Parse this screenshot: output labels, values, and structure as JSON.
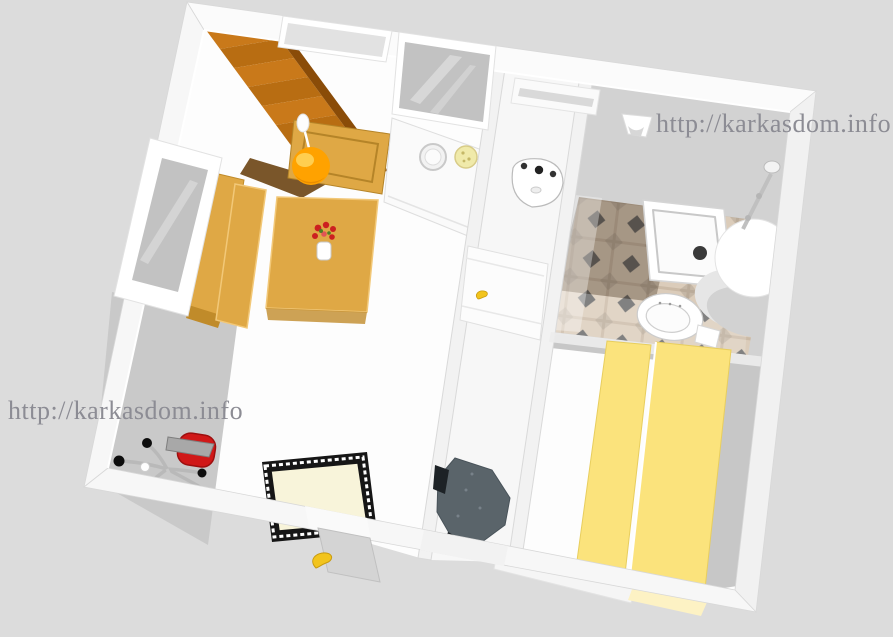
{
  "watermarks": {
    "top_right": "http://karkasdom.info",
    "bottom_left": "http://karkasdom.info"
  },
  "colors": {
    "background": "#dcdcdc",
    "watermark_gray": "#8c8c94",
    "wall_white": "#f7f7f7",
    "wall_top_band": "#fbfbfb",
    "floor_white": "#fdfdfd",
    "floor_shadow": "#c9c9c9",
    "bath_shadow_floor": "#d2d2d2",
    "glass_gray": "#c2c2c2",
    "glass_light": "#e2e2e2",
    "stairs_top": "#c9791a",
    "stairs_step": "#b86d12",
    "stairs_side": "#8a4c08",
    "stairs_shadow": "#6b4413",
    "wood_tan": "#dfa845",
    "wood_tan_side": "#c08b2a",
    "lamp_orange": "#ffa200",
    "lamp_highlight": "#ffd65e",
    "tile_base": "#dbccba",
    "tile_diamond": "#666666",
    "bed_yellow": "#fbe37c",
    "bed_pale": "#fdf2c4",
    "rug_cream": "#f8f4da",
    "rug_black": "#161616",
    "chair_red": "#d01818",
    "chair_gray": "#a8a8a8",
    "armchair_gray": "#5a646a",
    "banana_yellow": "#f2c41d",
    "flower_red": "#cc2020",
    "fixture_white": "#ffffff"
  }
}
